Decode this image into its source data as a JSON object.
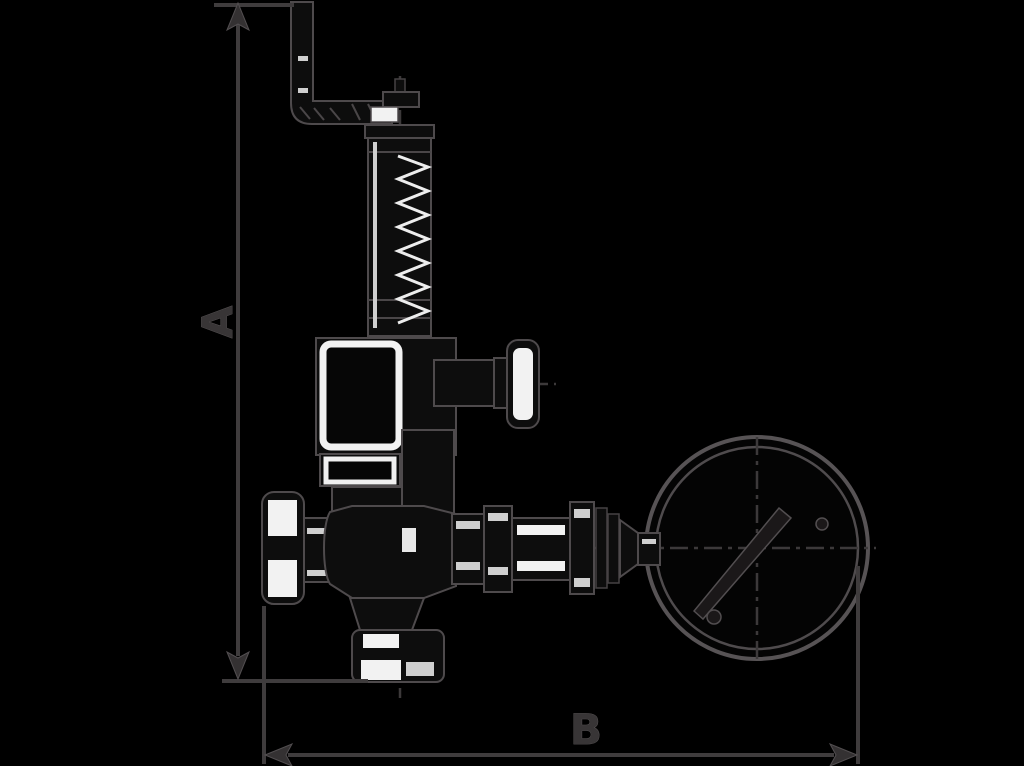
{
  "page": {
    "background": "#000000"
  },
  "labels": {
    "A": "A",
    "B": "B"
  },
  "diagram": {
    "type": "technical-line-drawing",
    "subject": "safety-relief-valve-with-test-lever-and-pressure-gauge",
    "ink_color": "#231f20",
    "outline_halo_color": "#4e4a4c",
    "white_fill_color": "#f2f2f2",
    "dimension_line_color": "#3f3c3d",
    "dimension_labels": [
      "A",
      "B"
    ]
  }
}
